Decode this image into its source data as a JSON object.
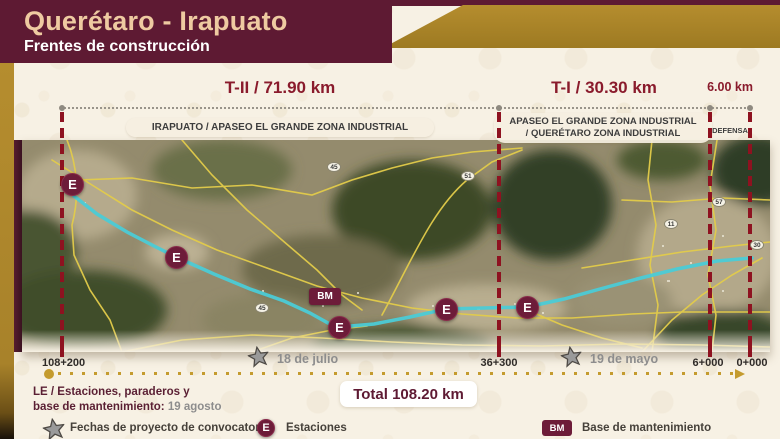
{
  "header": {
    "title": "Querétaro - Irapuato",
    "subtitle": "Frentes de construcción"
  },
  "sections": {
    "t2": {
      "label": "T-II / 71.90 km",
      "zone": "IRAPUATO / APASEO EL GRANDE ZONA INDUSTRIAL"
    },
    "t1": {
      "label": "T-I / 30.30 km",
      "zone_line1": "APASEO EL GRANDE ZONA INDUSTRIAL",
      "zone_line2": "/ QUERÉTARO ZONA INDUSTRIAL"
    },
    "defensa": {
      "label": "6.00 km",
      "zone": "DEFENSA"
    }
  },
  "map": {
    "stations": [
      {
        "label": "E"
      },
      {
        "label": "E"
      },
      {
        "label": "E"
      },
      {
        "label": "E"
      },
      {
        "label": "E"
      }
    ],
    "bm_label": "BM",
    "shields": [
      {
        "label": "45"
      },
      {
        "label": "51"
      },
      {
        "label": "45"
      },
      {
        "label": "57"
      },
      {
        "label": "11"
      },
      {
        "label": "30"
      }
    ]
  },
  "chainages": [
    {
      "value": "108+200"
    },
    {
      "value": "36+300"
    },
    {
      "value": "6+000"
    },
    {
      "value": "0+000"
    }
  ],
  "milestones": [
    {
      "date": "18 de julio"
    },
    {
      "date": "19 de mayo"
    }
  ],
  "total": {
    "label": "Total 108.20 km"
  },
  "legend": {
    "le_line1": "LE / Estaciones, paraderos y",
    "le_line2_bold": "base de mantenimiento:",
    "le_line2_value": "19 agosto",
    "star_label": "Fechas de proyecto de convocatoria",
    "station_badge": "E",
    "station_label": "Estaciones",
    "bm_badge": "BM",
    "bm_label": "Base de mantenimiento"
  },
  "colors": {
    "maroon": "#5e1a33",
    "gold": "#ab8628",
    "boundary_red": "#8e1220",
    "route_cyan": "#4bcbd6",
    "cream": "#f7f1e4",
    "title_tan": "#eecaa1"
  }
}
